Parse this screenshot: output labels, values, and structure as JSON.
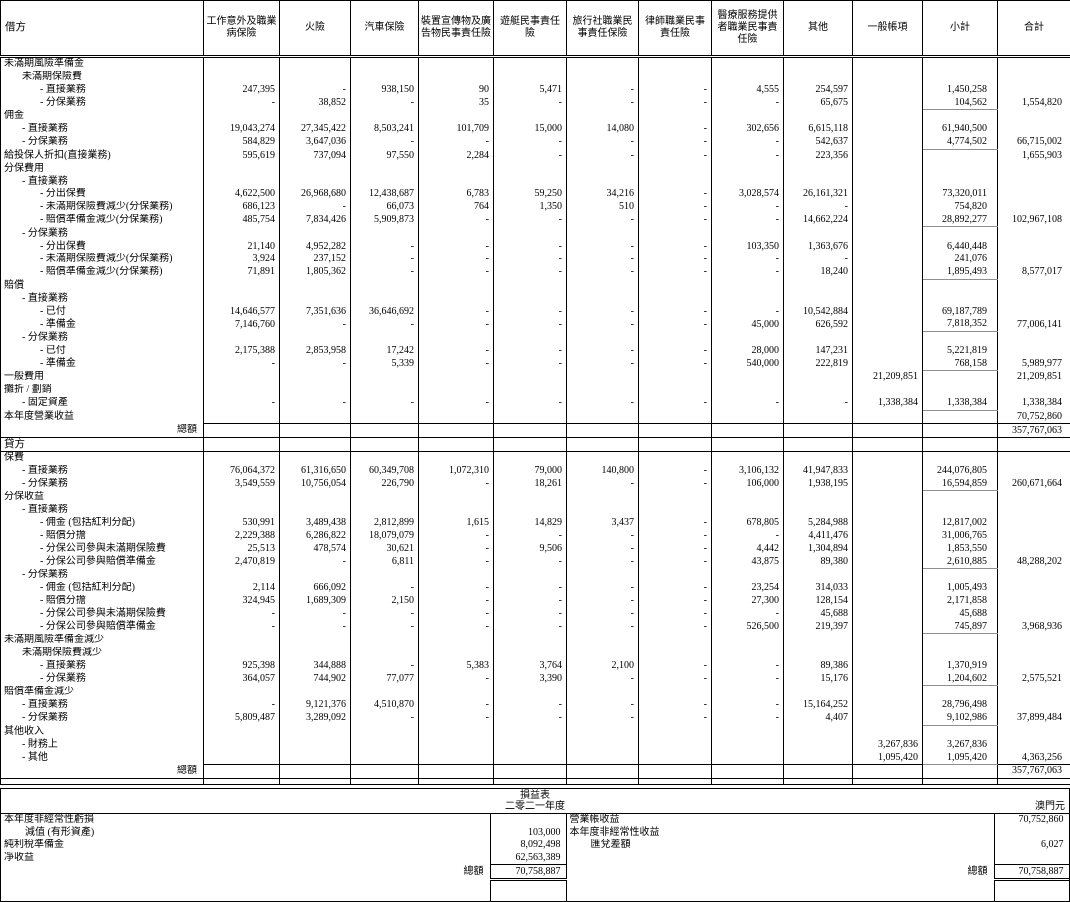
{
  "table": {
    "debit_label": "借方",
    "credit_label": "貸方",
    "total_label": "總額",
    "debit_total": "357,767,063",
    "credit_total": "357,767,063",
    "columns": [
      "工作意外及職業病保險",
      "火險",
      "汽車保險",
      "裝置宣傳物及廣告物民事責任險",
      "遊艇民事責任險",
      "旅行社職業民事責任保險",
      "律師職業民事責任險",
      "醫療服務提供者職業民事責任險",
      "其他",
      "一般帳項",
      "小計",
      "合計"
    ],
    "debit_rows": [
      {
        "label": "未滿期風險準備金",
        "indent": 0
      },
      {
        "label": "未滿期保險費",
        "indent": 1
      },
      {
        "label": "- 直接業務",
        "indent": 2,
        "values": [
          "247,395",
          "-",
          "938,150",
          "90",
          "5,471",
          "-",
          "-",
          "4,555",
          "254,597",
          "",
          "1,450,258",
          ""
        ]
      },
      {
        "label": "- 分保業務",
        "indent": 2,
        "sum": true,
        "values": [
          "-",
          "38,852",
          "-",
          "35",
          "-",
          "-",
          "-",
          "-",
          "65,675",
          "",
          "104,562",
          "1,554,820"
        ]
      },
      {
        "label": "佣金",
        "indent": 0
      },
      {
        "label": "- 直接業務",
        "indent": 1,
        "values": [
          "19,043,274",
          "27,345,422",
          "8,503,241",
          "101,709",
          "15,000",
          "14,080",
          "-",
          "302,656",
          "6,615,118",
          "",
          "61,940,500",
          ""
        ]
      },
      {
        "label": "- 分保業務",
        "indent": 1,
        "sum": true,
        "values": [
          "584,829",
          "3,647,036",
          "-",
          "-",
          "-",
          "-",
          "-",
          "-",
          "542,637",
          "",
          "4,774,502",
          "66,715,002"
        ]
      },
      {
        "label": "給投保人折扣(直接業務)",
        "indent": 0,
        "values": [
          "595,619",
          "737,094",
          "97,550",
          "2,284",
          "-",
          "-",
          "-",
          "-",
          "223,356",
          "",
          "",
          "1,655,903"
        ]
      },
      {
        "label": "分保費用",
        "indent": 0
      },
      {
        "label": "- 直接業務",
        "indent": 1
      },
      {
        "label": "- 分出保費",
        "indent": 2,
        "values": [
          "4,622,500",
          "26,968,680",
          "12,438,687",
          "6,783",
          "59,250",
          "34,216",
          "-",
          "3,028,574",
          "26,161,321",
          "",
          "73,320,011",
          ""
        ]
      },
      {
        "label": "- 未滿期保險費減少(分保業務)",
        "indent": 2,
        "values": [
          "686,123",
          "-",
          "66,073",
          "764",
          "1,350",
          "510",
          "-",
          "-",
          "-",
          "",
          "754,820",
          ""
        ]
      },
      {
        "label": "- 賠償準備金減少(分保業務)",
        "indent": 2,
        "sum": true,
        "values": [
          "485,754",
          "7,834,426",
          "5,909,873",
          "-",
          "-",
          "-",
          "-",
          "-",
          "14,662,224",
          "",
          "28,892,277",
          "102,967,108"
        ]
      },
      {
        "label": "- 分保業務",
        "indent": 1
      },
      {
        "label": "- 分出保費",
        "indent": 2,
        "values": [
          "21,140",
          "4,952,282",
          "-",
          "-",
          "-",
          "-",
          "-",
          "103,350",
          "1,363,676",
          "",
          "6,440,448",
          ""
        ]
      },
      {
        "label": "- 未滿期保險費減少(分保業務)",
        "indent": 2,
        "values": [
          "3,924",
          "237,152",
          "-",
          "-",
          "-",
          "-",
          "-",
          "-",
          "-",
          "",
          "241,076",
          ""
        ]
      },
      {
        "label": "- 賠償準備金減少(分保業務)",
        "indent": 2,
        "sum": true,
        "values": [
          "71,891",
          "1,805,362",
          "-",
          "-",
          "-",
          "-",
          "-",
          "-",
          "18,240",
          "",
          "1,895,493",
          "8,577,017"
        ]
      },
      {
        "label": "賠償",
        "indent": 0
      },
      {
        "label": "- 直接業務",
        "indent": 1
      },
      {
        "label": "- 已付",
        "indent": 2,
        "values": [
          "14,646,577",
          "7,351,636",
          "36,646,692",
          "-",
          "-",
          "-",
          "-",
          "-",
          "10,542,884",
          "",
          "69,187,789",
          ""
        ]
      },
      {
        "label": "- 準備金",
        "indent": 2,
        "sum": true,
        "values": [
          "7,146,760",
          "-",
          "-",
          "-",
          "-",
          "-",
          "-",
          "45,000",
          "626,592",
          "",
          "7,818,352",
          "77,006,141"
        ]
      },
      {
        "label": "- 分保業務",
        "indent": 1
      },
      {
        "label": "- 已付",
        "indent": 2,
        "values": [
          "2,175,388",
          "2,853,958",
          "17,242",
          "-",
          "-",
          "-",
          "-",
          "28,000",
          "147,231",
          "",
          "5,221,819",
          ""
        ]
      },
      {
        "label": "- 準備金",
        "indent": 2,
        "sum": true,
        "values": [
          "-",
          "-",
          "5,339",
          "-",
          "-",
          "-",
          "-",
          "540,000",
          "222,819",
          "",
          "768,158",
          "5,989,977"
        ]
      },
      {
        "label": "一般費用",
        "indent": 0,
        "values": [
          "",
          "",
          "",
          "",
          "",
          "",
          "",
          "",
          "",
          "21,209,851",
          "",
          "21,209,851"
        ]
      },
      {
        "label": "攤折 / 劃銷",
        "indent": 0
      },
      {
        "label": "- 固定資產",
        "indent": 1,
        "sum": true,
        "values": [
          "-",
          "-",
          "-",
          "-",
          "-",
          "-",
          "-",
          "-",
          "-",
          "1,338,384",
          "1,338,384",
          "1,338,384"
        ]
      },
      {
        "label": "本年度營業收益",
        "indent": 0,
        "values": [
          "",
          "",
          "",
          "",
          "",
          "",
          "",
          "",
          "",
          "",
          "",
          "70,752,860"
        ]
      }
    ],
    "credit_rows": [
      {
        "label": "保費",
        "indent": 0
      },
      {
        "label": "- 直接業務",
        "indent": 1,
        "values": [
          "76,064,372",
          "61,316,650",
          "60,349,708",
          "1,072,310",
          "79,000",
          "140,800",
          "-",
          "3,106,132",
          "41,947,833",
          "",
          "244,076,805",
          ""
        ]
      },
      {
        "label": "- 分保業務",
        "indent": 1,
        "sum": true,
        "values": [
          "3,549,559",
          "10,756,054",
          "226,790",
          "-",
          "18,261",
          "-",
          "-",
          "106,000",
          "1,938,195",
          "",
          "16,594,859",
          "260,671,664"
        ]
      },
      {
        "label": "分保收益",
        "indent": 0
      },
      {
        "label": "- 直接業務",
        "indent": 1
      },
      {
        "label": "- 佣金 (包括紅利分配)",
        "indent": 2,
        "values": [
          "530,991",
          "3,489,438",
          "2,812,899",
          "1,615",
          "14,829",
          "3,437",
          "-",
          "678,805",
          "5,284,988",
          "",
          "12,817,002",
          ""
        ]
      },
      {
        "label": "- 賠償分擔",
        "indent": 2,
        "values": [
          "2,229,388",
          "6,286,822",
          "18,079,079",
          "-",
          "-",
          "-",
          "-",
          "-",
          "4,411,476",
          "",
          "31,006,765",
          ""
        ]
      },
      {
        "label": "- 分保公司參與未滿期保險費",
        "indent": 2,
        "values": [
          "25,513",
          "478,574",
          "30,621",
          "-",
          "9,506",
          "-",
          "-",
          "4,442",
          "1,304,894",
          "",
          "1,853,550",
          ""
        ]
      },
      {
        "label": "- 分保公司參與賠償準備金",
        "indent": 2,
        "sum": true,
        "values": [
          "2,470,819",
          "-",
          "6,811",
          "-",
          "-",
          "-",
          "-",
          "43,875",
          "89,380",
          "",
          "2,610,885",
          "48,288,202"
        ]
      },
      {
        "label": "- 分保業務",
        "indent": 1
      },
      {
        "label": "- 佣金 (包括紅利分配)",
        "indent": 2,
        "values": [
          "2,114",
          "666,092",
          "-",
          "-",
          "-",
          "-",
          "-",
          "23,254",
          "314,033",
          "",
          "1,005,493",
          ""
        ]
      },
      {
        "label": "- 賠償分擔",
        "indent": 2,
        "values": [
          "324,945",
          "1,689,309",
          "2,150",
          "-",
          "-",
          "-",
          "-",
          "27,300",
          "128,154",
          "",
          "2,171,858",
          ""
        ]
      },
      {
        "label": "- 分保公司參與未滿期保險費",
        "indent": 2,
        "values": [
          "-",
          "-",
          "-",
          "-",
          "-",
          "-",
          "-",
          "-",
          "45,688",
          "",
          "45,688",
          ""
        ]
      },
      {
        "label": "- 分保公司參與賠償準備金",
        "indent": 2,
        "sum": true,
        "values": [
          "-",
          "-",
          "-",
          "-",
          "-",
          "-",
          "-",
          "526,500",
          "219,397",
          "",
          "745,897",
          "3,968,936"
        ]
      },
      {
        "label": "未滿期風險準備金減少",
        "indent": 0
      },
      {
        "label": "未滿期保險費減少",
        "indent": 1
      },
      {
        "label": "- 直接業務",
        "indent": 2,
        "values": [
          "925,398",
          "344,888",
          "-",
          "5,383",
          "3,764",
          "2,100",
          "-",
          "-",
          "89,386",
          "",
          "1,370,919",
          ""
        ]
      },
      {
        "label": "- 分保業務",
        "indent": 2,
        "sum": true,
        "values": [
          "364,057",
          "744,902",
          "77,077",
          "-",
          "3,390",
          "-",
          "-",
          "-",
          "15,176",
          "",
          "1,204,602",
          "2,575,521"
        ]
      },
      {
        "label": "賠償準備金減少",
        "indent": 0
      },
      {
        "label": "- 直接業務",
        "indent": 1,
        "values": [
          "-",
          "9,121,376",
          "4,510,870",
          "-",
          "-",
          "-",
          "-",
          "-",
          "15,164,252",
          "",
          "28,796,498",
          ""
        ]
      },
      {
        "label": "- 分保業務",
        "indent": 1,
        "sum": true,
        "values": [
          "5,809,487",
          "3,289,092",
          "-",
          "-",
          "-",
          "-",
          "-",
          "-",
          "4,407",
          "",
          "9,102,986",
          "37,899,484"
        ]
      },
      {
        "label": "其他收入",
        "indent": 0
      },
      {
        "label": "- 財務上",
        "indent": 1,
        "values": [
          "",
          "",
          "",
          "",
          "",
          "",
          "",
          "",
          "",
          "3,267,836",
          "3,267,836",
          ""
        ]
      },
      {
        "label": "- 其他",
        "indent": 1,
        "sum": true,
        "values": [
          "",
          "",
          "",
          "",
          "",
          "",
          "",
          "",
          "",
          "1,095,420",
          "1,095,420",
          "4,363,256"
        ]
      }
    ]
  },
  "income_statement": {
    "title": "損益表",
    "period": "二零二一年度",
    "currency": "澳門元",
    "total_label": "總額",
    "left_total": "70,758,887",
    "right_total": "70,758,887",
    "left_rows": [
      {
        "label": "本年度非經常性虧損",
        "value": ""
      },
      {
        "label": "減值 (有形資產)",
        "value": "103,000"
      },
      {
        "label": "純利稅準備金",
        "value": "8,092,498"
      },
      {
        "label": "凈收益",
        "value": "62,563,389"
      }
    ],
    "right_rows": [
      {
        "label": "營業帳收益",
        "value": "70,752,860"
      },
      {
        "label": "本年度非經常性收益",
        "value": ""
      },
      {
        "label": "匯兌差額",
        "value": "6,027"
      },
      {
        "label": "",
        "value": ""
      }
    ]
  }
}
